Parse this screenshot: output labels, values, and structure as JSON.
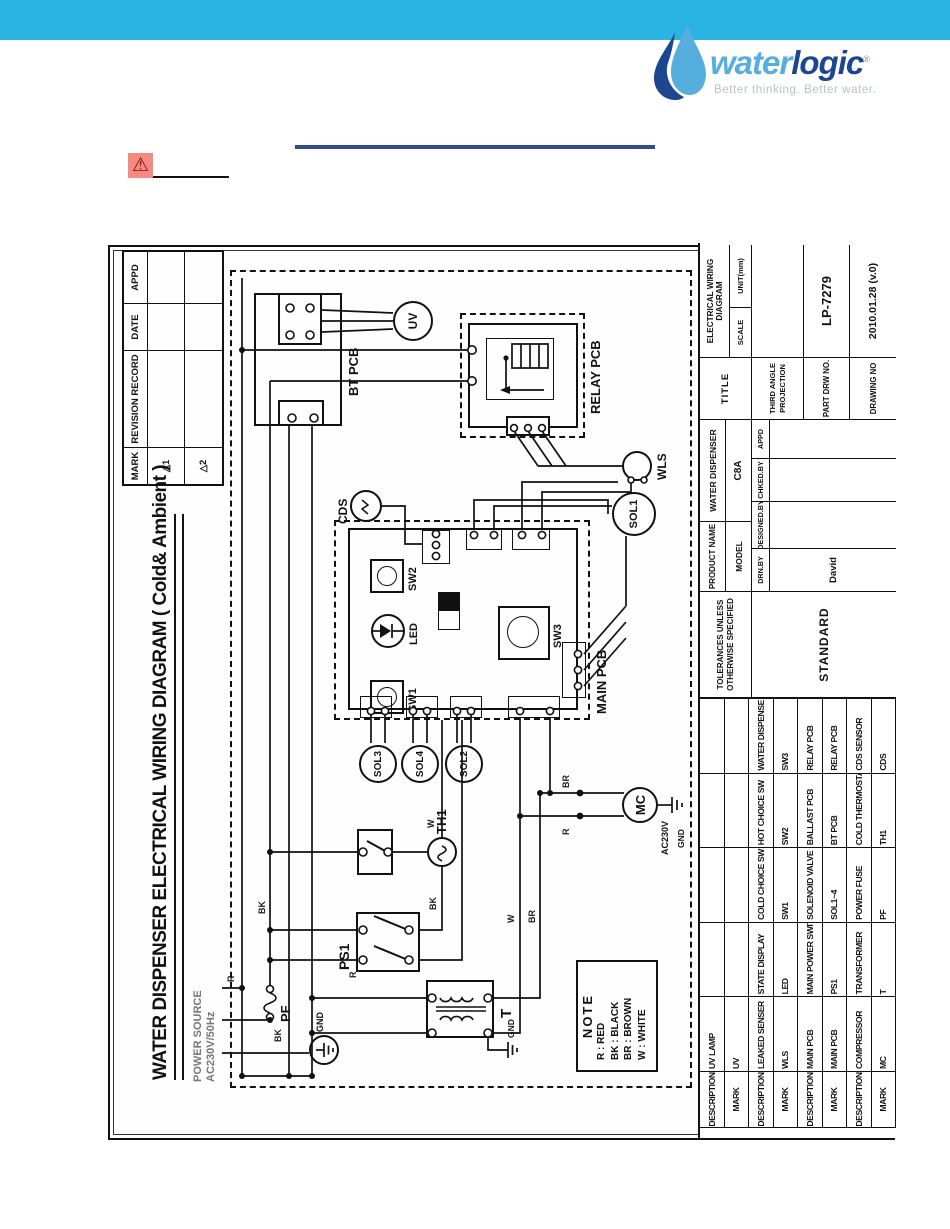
{
  "logo": {
    "brand_water": "water",
    "brand_logic": "logic",
    "registered": "®",
    "tagline": "Better thinking. Better water.",
    "colors": {
      "light_blue": "#56aede",
      "dark_blue": "#1d4690",
      "topbar": "#2ab4e4"
    }
  },
  "header": {
    "warning_icon_char": "⚠"
  },
  "drawing": {
    "title": "WATER  DISPENSER ELECTRICAL WIRING DIAGRAM ( Cold& Ambient )",
    "power_source_line1": "POWER SOURCE",
    "power_source_line2": "AC230V/50Hz",
    "revision_table": {
      "headers": [
        "MARK",
        "REVISION  RECORD",
        "DATE",
        "APPD"
      ],
      "rows": [
        [
          "△1",
          "",
          "",
          ""
        ],
        [
          "△2",
          "",
          "",
          ""
        ]
      ]
    },
    "note": {
      "title": "NOTE",
      "lines": [
        "R  : RED",
        "BK : BLACK",
        "BR : BROWN",
        "W  : WHITE"
      ]
    },
    "components": {
      "bt_pcb": "BT PCB",
      "uv": "UV",
      "relay_pcb": "RELAY PCB",
      "cds": "CDS",
      "wls": "WLS",
      "sol1": "SOL1",
      "sol2": "SOL2",
      "sol3": "SOL3",
      "sol4": "SOL4",
      "main_pcb": "MAIN PCB",
      "sw1": "SW1",
      "sw2": "SW2",
      "sw3": "SW3",
      "led": "LED",
      "ps1": "PS1",
      "th1": "TH1",
      "t": "T",
      "pf": "PF",
      "mc": "MC",
      "gnd1": "GND",
      "gnd2": "GND",
      "gnd3": "GND",
      "ac230v": "AC230V"
    },
    "wire_labels": {
      "r1": "R",
      "bk1": "BK",
      "bk2": "BK",
      "r2": "R",
      "bk3": "BK",
      "w1": "W",
      "w2": "W",
      "br1": "BR",
      "r3": "R",
      "br2": "BR"
    },
    "parts_rows": [
      [
        "DESCRIPTION",
        "UV LAMP",
        "",
        "",
        "",
        ""
      ],
      [
        "MARK",
        "UV",
        "",
        "",
        "",
        ""
      ],
      [
        "DESCRIPTION",
        "LEAKED SENSER",
        "STATE DISPLAY",
        "COLD CHOICE SW",
        "HOT CHOICE SW",
        "WATER DISPENSE"
      ],
      [
        "MARK",
        "WLS",
        "LED",
        "SW1",
        "SW2",
        "SW3"
      ],
      [
        "DESCRIPTION",
        "MAIN PCB",
        "MAIN POWER SWITCH",
        "SOLENOID VALVE",
        "BALLAST PCB",
        "RELAY PCB"
      ],
      [
        "MARK",
        "MAIN PCB",
        "PS1",
        "SOL1~4",
        "BT PCB",
        "RELAY PCB"
      ],
      [
        "DESCRIPTION",
        "COMPRESSOR",
        "TRANSFORMER",
        "POWER FUSE",
        "COLD THERMOSTAT",
        "CDS SENSOR"
      ],
      [
        "MARK",
        "MC",
        "T",
        "PF",
        "TH1",
        "CDS"
      ]
    ],
    "title_block": {
      "tolerances_line1": "TOLERANCES UNLESS",
      "tolerances_line2": "OTHERWISE SPECIFIED",
      "standard": "STANDARD",
      "product_name_label": "PRODUCT NAME",
      "product_name": "WATER DISPENSER",
      "model_label": "MODEL",
      "model": "C8A",
      "signoff_headers": [
        "DRN.BY",
        "DESIGNED.BY",
        "CHKED.BY",
        "APPD"
      ],
      "drawn_by": "David",
      "title_label": "TITLE",
      "title_value": "ELECTRICAL WIRING DIAGRAM",
      "scale_label": "SCALE",
      "unit_label": "UNIT(mm)",
      "projection": "THIRD ANGLE PROJECTION",
      "part_drw_no_label": "PART DRW NO.",
      "part_drw_no": "LP-7279",
      "drawing_no_label": "DRAWING NO",
      "drawing_no": "2010.01.28 (v.0)"
    }
  }
}
